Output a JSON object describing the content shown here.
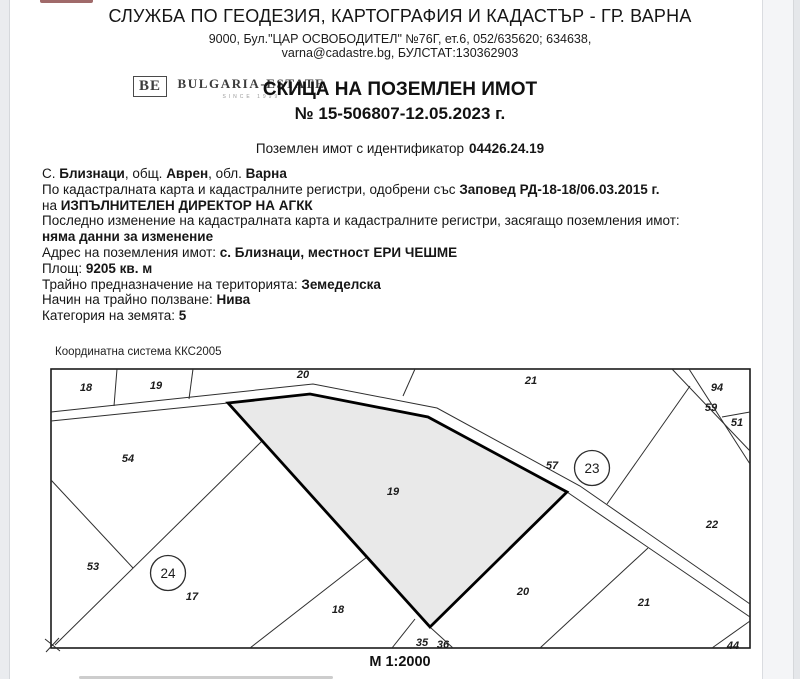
{
  "header": {
    "office": "СЛУЖБА ПО ГЕОДЕЗИЯ, КАРТОГРАФИЯ И КАДАСТЪР - ГР. ВАРНА",
    "address_line1": "9000, Бул.\"ЦАР ОСВОБОДИТЕЛ\" №76Г, ет.6, 052/635620; 634638,",
    "address_line2": "varna@cadastre.bg, БУЛСТАТ:130362903"
  },
  "logo": {
    "initials": "BE",
    "name": "BULGARIA-ESTATE",
    "tagline": "SINCE 1999"
  },
  "title": {
    "line1": "СКИЦА НА ПОЗЕМЛЕН ИМОТ",
    "line2": "№ 15-506807-12.05.2023 г."
  },
  "identifier": {
    "label": "Поземлен имот с идентификатор",
    "value": "04426.24.19"
  },
  "details": [
    {
      "segs": [
        {
          "t": "С. "
        },
        {
          "t": "Близнаци"
        },
        {
          "t": ", общ. "
        },
        {
          "t": "Аврен"
        },
        {
          "t": ", обл. "
        },
        {
          "t": "Варна"
        }
      ]
    },
    {
      "segs": [
        {
          "t": "По кадастралната карта и кадастралните регистри, одобрени със "
        },
        {
          "t": "Заповед РД-18-18/06.03.2015 г."
        }
      ]
    },
    {
      "segs": [
        {
          "t": "на "
        },
        {
          "t": "ИЗПЪЛНИТЕЛЕН ДИРЕКТОР НА АГКК"
        }
      ]
    },
    {
      "segs": [
        {
          "t": "Последно изменение на кадастралната карта и кадастралните регистри, засягащо поземления имот:"
        }
      ]
    },
    {
      "segs": [
        {
          "t": "няма данни за изменение"
        }
      ]
    },
    {
      "segs": [
        {
          "t": "Адрес на поземления имот: "
        },
        {
          "t": "с. Близнаци, местност ЕРИ ЧЕШМЕ"
        }
      ]
    },
    {
      "segs": [
        {
          "t": "Площ: "
        },
        {
          "t": "9205 кв. м"
        }
      ]
    },
    {
      "segs": [
        {
          "t": "Трайно предназначение на територията: "
        },
        {
          "t": "Земеделска"
        }
      ]
    },
    {
      "segs": [
        {
          "t": "Начин на трайно ползване: "
        },
        {
          "t": "Нива"
        }
      ]
    },
    {
      "segs": [
        {
          "t": "Категория на земята: "
        },
        {
          "t": "5"
        }
      ]
    }
  ],
  "map": {
    "coord_system": "Координатна система ККС2005",
    "scale": "М 1:2000",
    "highlight_fill": "#e9e9e9",
    "labels": [
      {
        "t": "18",
        "x": 86,
        "y": 391
      },
      {
        "t": "19",
        "x": 156,
        "y": 389
      },
      {
        "t": "20",
        "x": 303,
        "y": 378
      },
      {
        "t": "21",
        "x": 531,
        "y": 384
      },
      {
        "t": "94",
        "x": 717,
        "y": 391
      },
      {
        "t": "59",
        "x": 711,
        "y": 411
      },
      {
        "t": "51",
        "x": 737,
        "y": 426
      },
      {
        "t": "57",
        "x": 552,
        "y": 469
      },
      {
        "t": "22",
        "x": 712,
        "y": 528
      },
      {
        "t": "54",
        "x": 128,
        "y": 462
      },
      {
        "t": "53",
        "x": 93,
        "y": 570
      },
      {
        "t": "17",
        "x": 192,
        "y": 600
      },
      {
        "t": "19",
        "x": 393,
        "y": 495
      },
      {
        "t": "18",
        "x": 338,
        "y": 613
      },
      {
        "t": "20",
        "x": 523,
        "y": 595
      },
      {
        "t": "21",
        "x": 644,
        "y": 606
      },
      {
        "t": "35",
        "x": 422,
        "y": 646
      },
      {
        "t": "36",
        "x": 443,
        "y": 648
      },
      {
        "t": "44",
        "x": 733,
        "y": 649
      }
    ],
    "circled": [
      {
        "t": "23",
        "x": 592,
        "y": 468
      },
      {
        "t": "24",
        "x": 168,
        "y": 573
      }
    ]
  }
}
